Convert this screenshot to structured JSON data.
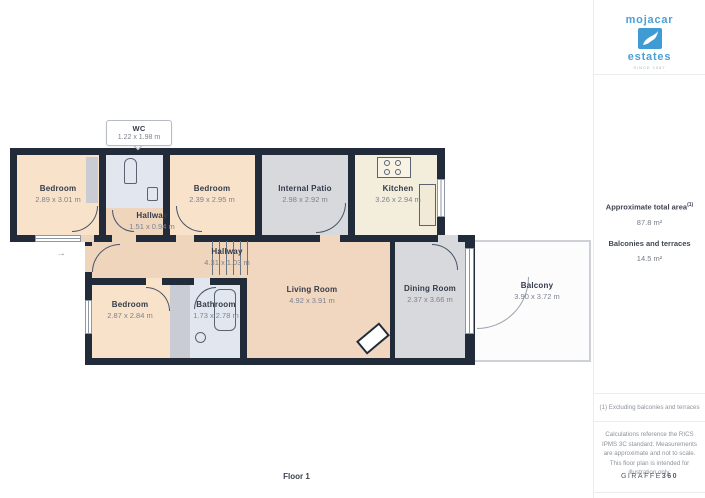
{
  "sidebar": {
    "logo": {
      "word1": "mojacar",
      "word2": "estates",
      "tagline": "SINCE 1987"
    },
    "area": {
      "title": "Approximate total area",
      "sup": "(1)",
      "value": "87.8 m²",
      "label2": "Balconies and terraces",
      "value2": "14.5 m²"
    },
    "footnote": "(1) Excluding balconies and terraces",
    "disclaimer": "Calculations reference the RICS IPMS 3C standard. Measurements are approximate and not to scale. This floor plan is intended for illustration only.",
    "brand_left": "GIRAFFE",
    "brand_right": "360"
  },
  "plan": {
    "floor_label": "Floor 1",
    "rooms": [
      {
        "name": "Bedroom",
        "dims": "2.89 x 3.01 m"
      },
      {
        "name": "WC",
        "dims": "1.22 x 1.98 m"
      },
      {
        "name": "Bedroom",
        "dims": "2.39 x 2.95 m"
      },
      {
        "name": "Internal Patio",
        "dims": "2.98 x 2.92 m"
      },
      {
        "name": "Kitchen",
        "dims": "3.26 x 2.94 m"
      },
      {
        "name": "Hallway",
        "dims": "1.51 x 0.94 m"
      },
      {
        "name": "Hallway",
        "dims": "4.31 x 1.03 m"
      },
      {
        "name": "Bedroom",
        "dims": "2.87 x 2.84 m"
      },
      {
        "name": "Bathroom",
        "dims": "1.73 x 2.78 m"
      },
      {
        "name": "Living Room",
        "dims": "4.92 x 3.91 m"
      },
      {
        "name": "Dining Room",
        "dims": "2.37 x 3.66 m"
      },
      {
        "name": "Balcony",
        "dims": "3.90 x 3.72 m"
      }
    ]
  },
  "colors": {
    "wall": "#222b3a",
    "bedroom_fill": "#f8e2c9",
    "hallway_fill": "#eed5bc",
    "living_fill": "#f2d7c0",
    "kitchen_fill": "#f3eddc",
    "patio_dining_fill": "#d7d9dc",
    "wet_room_fill": "#e2e6ee",
    "closet_fill": "#c9cdd3",
    "balcony_fill": "#fcfcfc",
    "brand_blue": "#4ba0d6"
  }
}
